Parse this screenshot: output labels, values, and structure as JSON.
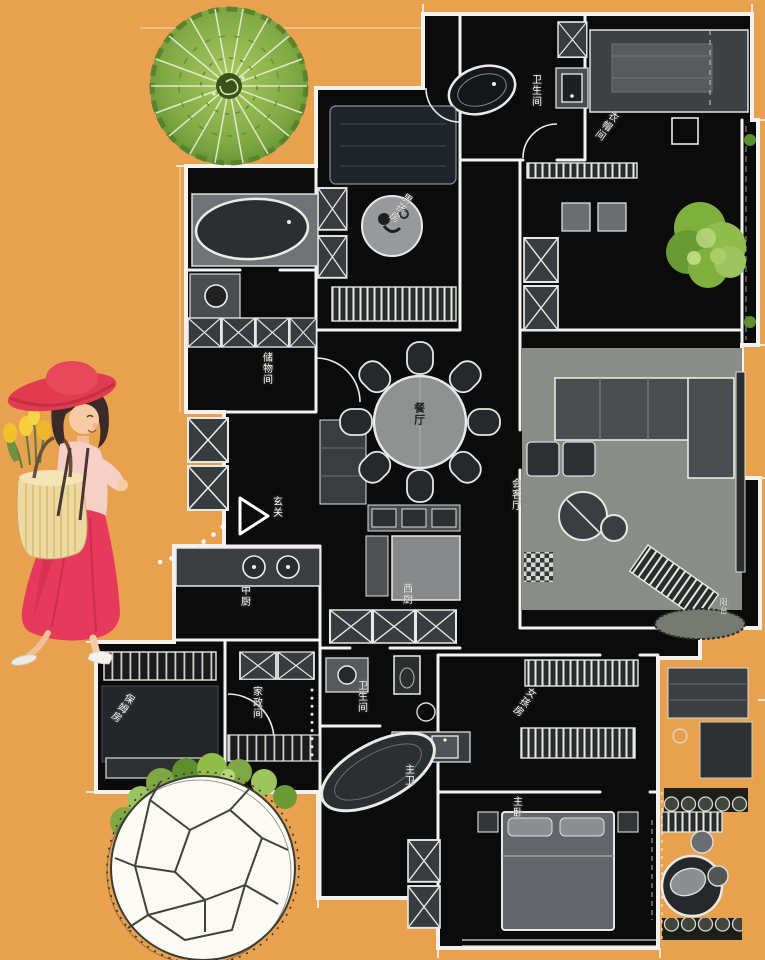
{
  "scene": {
    "type": "stylized-residential-floor-plan-illustration",
    "background_color": "#E8A14F",
    "plan_color": "#0B0B0C",
    "wall_color": "#F3F2EE",
    "furniture_gray": "#8E9090",
    "foliage_green": "#7FA844",
    "accent_red": "#E23B4F",
    "straw_color": "#ECD9A0"
  },
  "floor_plan": {
    "rooms": [
      {
        "name": "卫生间",
        "orientation": "vertical"
      },
      {
        "name": "衣帽间",
        "orientation": "diagonal"
      },
      {
        "name": "男孩房",
        "orientation": "diagonal"
      },
      {
        "name": "储物间",
        "orientation": "vertical"
      },
      {
        "name": "餐厅",
        "orientation": "vertical"
      },
      {
        "name": "玄关",
        "orientation": "vertical"
      },
      {
        "name": "会客厅",
        "orientation": "vertical"
      },
      {
        "name": "中厨",
        "orientation": "vertical"
      },
      {
        "name": "西厨",
        "orientation": "vertical"
      },
      {
        "name": "家政间",
        "orientation": "vertical"
      },
      {
        "name": "卫生间",
        "orientation": "vertical"
      },
      {
        "name": "女孩房",
        "orientation": "diagonal"
      },
      {
        "name": "保姆房",
        "orientation": "diagonal"
      },
      {
        "name": "主卫",
        "orientation": "vertical"
      },
      {
        "name": "主卧",
        "orientation": "vertical"
      },
      {
        "name": "阳台",
        "orientation": "vertical"
      }
    ]
  },
  "decorations": {
    "fan_tree": "round-fan-tree",
    "bush": "green-bush",
    "sketch_tree": "sketched-tree-canopy",
    "woman": "walking-woman-red-dress",
    "entry_marker": "entry-arrow"
  }
}
